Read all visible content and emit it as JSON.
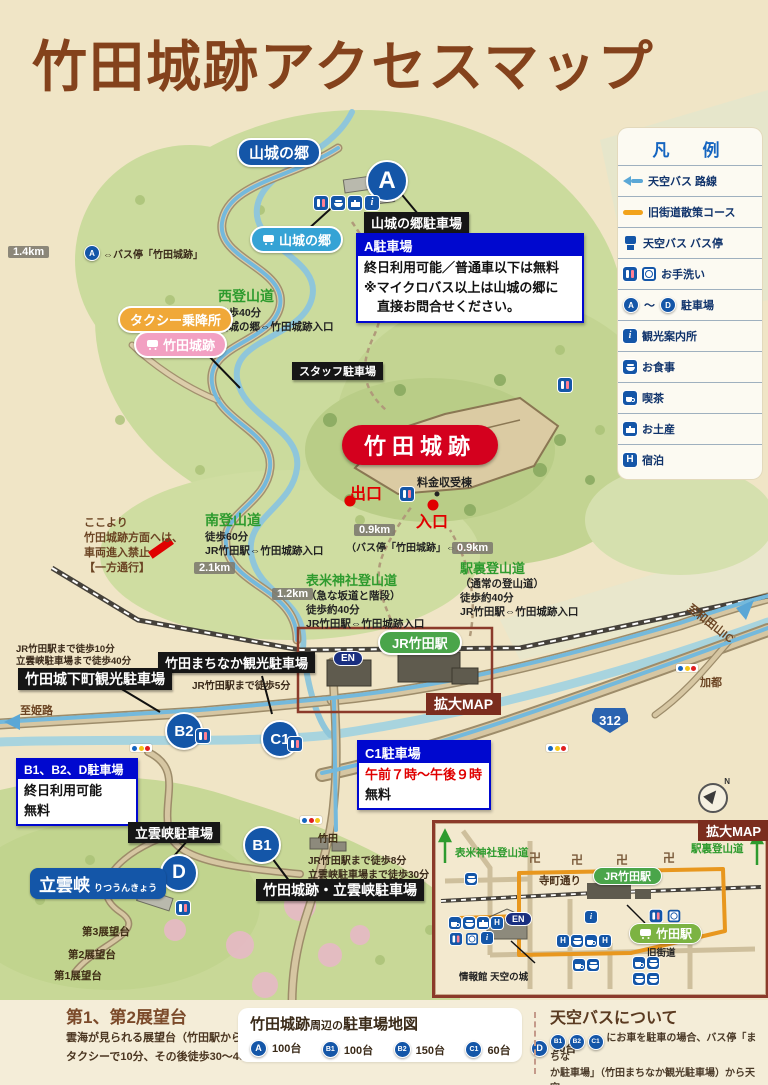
{
  "title": "竹田城跡アクセスマップ",
  "colors": {
    "title_brown": "#84421c",
    "castle_red": "#d4001e",
    "parking_blue": "#1456a8",
    "trail_green": "#2e9b2e",
    "legend_blue": "#1565c0",
    "taxi_orange": "#f0a838",
    "bus_stop_pink": "#f2a0c2",
    "sky_bus_route_blue": "#74b9dc",
    "old_road_orange": "#e8971e"
  },
  "legend": {
    "title": "凡　例",
    "items": [
      {
        "label": "天空バス 路線"
      },
      {
        "label": "旧街道散策コース"
      },
      {
        "label": "天空バス バス停"
      },
      {
        "label": "お手洗い"
      },
      {
        "label": "駐車場",
        "range": "～"
      },
      {
        "label": "観光案内所"
      },
      {
        "label": "お食事"
      },
      {
        "label": "喫茶"
      },
      {
        "label": "お土産"
      },
      {
        "label": "宿泊"
      }
    ]
  },
  "markers": {
    "a": "A",
    "b1": "B1",
    "b2": "B2",
    "c1": "C1",
    "d": "D"
  },
  "icons": {
    "info": "i",
    "hotel": "H",
    "en": "EN"
  },
  "map": {
    "yamajiro_area": "山城の郷",
    "yamajiro_bus_stop": "山城の郷",
    "yamajiro_parking": "山城の郷駐車場",
    "dist_1_4": "1.4km",
    "bus_link_a": "⇔バス停「竹田城跡」",
    "parking_a_box": {
      "title": "A駐車場",
      "line1": "終日利用可能／普通車以下は無料",
      "line2": "※マイクロバス以上は山城の郷に",
      "line3": "　直接お問合せください。"
    },
    "west_trail": {
      "name": "西登山道",
      "l1": "徒歩40分",
      "l2": "山城の郷⇔竹田城跡入口"
    },
    "taxi_stand": "タクシー乗降所",
    "castle_bus_stop": "竹田城跡",
    "staff_parking": "スタッフ駐車場",
    "castle": "竹田城跡",
    "exit": "出口",
    "toll_booth": "料金収受棟",
    "entrance": "入口",
    "dist_0_9_bus": "0.9km",
    "bus_entrance_pre": "（バス停「竹田城跡」⇔",
    "bus_entrance_red": "入口",
    "bus_entrance_post": "）",
    "dist_0_9_trail": "0.9km",
    "no_entry": {
      "l1": "ここより",
      "l2": "竹田城跡方面へは、",
      "l3": "車両進入禁止",
      "l4": "【一方通行】"
    },
    "south_trail": {
      "name": "南登山道",
      "l1": "徒歩60分",
      "l2": "JR竹田駅⇔竹田城跡入口"
    },
    "dist_2_1": "2.1km",
    "dist_1_2": "1.2km",
    "hyomai_trail": {
      "name": "表米神社登山道",
      "l1": "（急な坂道と階段）",
      "l2": "徒歩約40分",
      "l3": "JR竹田駅⇔竹田城跡入口"
    },
    "ekiura_trail": {
      "name": "駅裏登山道",
      "l1": "（通常の登山道）",
      "l2": "徒歩約40分",
      "l3": "JR竹田駅⇔竹田城跡入口"
    },
    "jr_station": "JR竹田駅",
    "kakudai_map": "拡大MAP",
    "machinaka_parking": "竹田まちなか観光駐車場",
    "machinaka_note": "JR竹田駅まで徒歩5分",
    "jokamachi_parking": "竹田城下町観光駐車場",
    "jokamachi_note1": "JR竹田駅まで徒歩10分",
    "jokamachi_note2": "立雲峡駐車場まで徒歩40分",
    "to_himeji": "至姫路",
    "b_box": {
      "title": "B1、B2、D駐車場",
      "l1": "終日利用可能",
      "l2": "無料"
    },
    "c1_box": {
      "title": "C1駐車場",
      "l1": "午前７時～午後９時",
      "l2": "無料"
    },
    "ritsuunkyo_parking": "立雲峡駐車場",
    "ritsuunkyo": "立雲峡",
    "ritsuunkyo_kana": "りつうんきょう",
    "viewpoint3": "第3展望台",
    "viewpoint2": "第2展望台",
    "viewpoint1": "第1展望台",
    "takeda_town": "竹田",
    "b1_note1": "JR竹田駅まで徒歩8分",
    "b1_note2": "立雲峡駐車場まで徒歩30分",
    "b1_parking": "竹田城跡・立雲峡駐車場",
    "route_312": "312",
    "kato": "加都",
    "to_wadayama": "至和田山IC",
    "compass_n": "N"
  },
  "inset": {
    "title": "拡大MAP",
    "hyomai_trail": "表米神社登山道",
    "ekiura_trail": "駅裏登山道",
    "temple": "卍",
    "teramachi_street": "寺町通り",
    "jr_station": "JR竹田駅",
    "takeda_bus_stop": "竹田駅",
    "old_road": "旧街道",
    "info_house": "情報館 天空の城"
  },
  "footer": {
    "viewpoints": {
      "title": "第1、第2展望台",
      "pre": "雲海が見られる展望台（竹田駅から駐車場",
      "post": "まで",
      "l2": "タクシーで10分、その後徒歩30～40分）"
    },
    "parking_table": {
      "t1": "竹田城跡",
      "t2": "周辺の",
      "t3": "駐車場地図",
      "items": [
        {
          "marker": "A",
          "count": "100台"
        },
        {
          "marker": "B1",
          "count": "100台"
        },
        {
          "marker": "B2",
          "count": "150台"
        },
        {
          "marker": "C1",
          "count": "60台"
        },
        {
          "marker": "D",
          "count": "50台"
        }
      ]
    },
    "skybus": {
      "title": "天空バスについて",
      "l1": "にお車を駐車の場合、バス停「まちな",
      "l2": "か駐車場」（竹田まちなか観光駐車場）から天空",
      "l3": "バスにご乗車ください。"
    }
  }
}
